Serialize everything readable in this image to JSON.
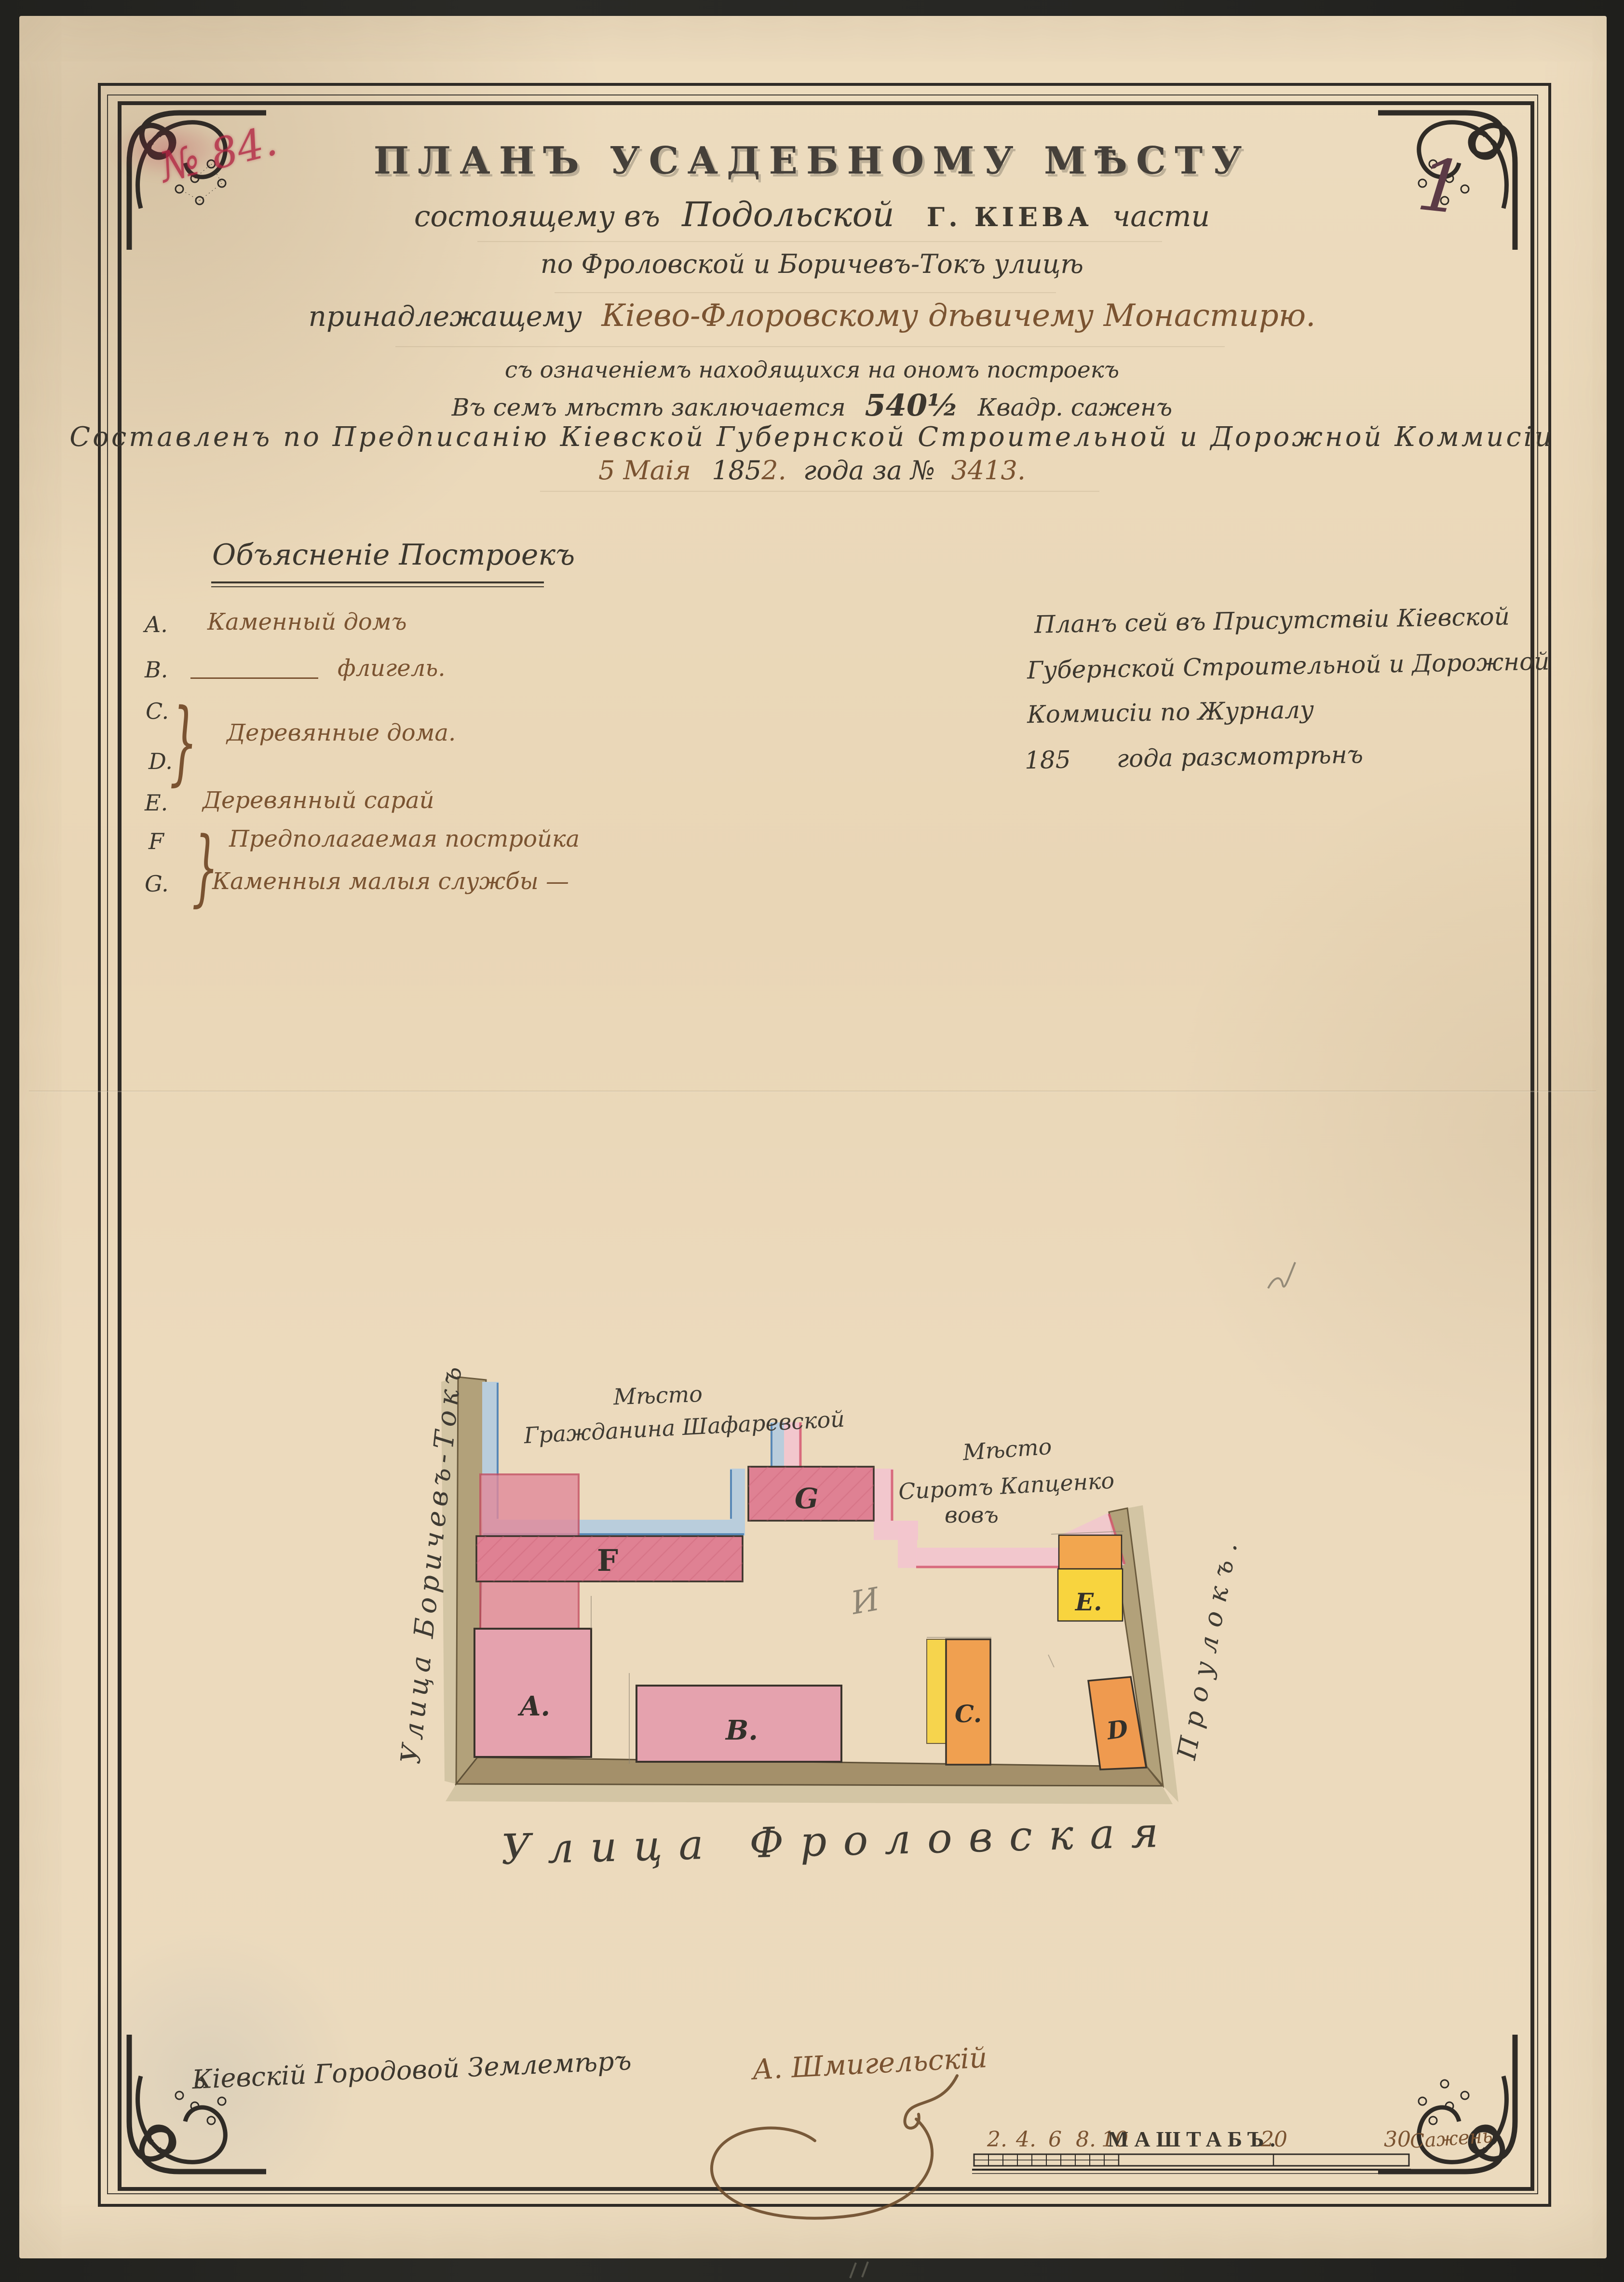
{
  "colors": {
    "paper": "#ecdcbf",
    "background": "#23231f",
    "ink": "#3c372e",
    "sepia": "#7a5331",
    "red_stamp": "#b22643",
    "pink_building": "#df8193",
    "pink_light": "#e5a2ae",
    "yellow": "#f6d44d",
    "orange": "#f0a050",
    "blue_band": "#b9cddc",
    "blue_edge": "#4e81b2",
    "pink_band": "#f2c6cd",
    "crimson_edge": "#d4596e",
    "street_tan": "#b2a17a"
  },
  "header": {
    "stamp": "№ 84.",
    "folio": "1"
  },
  "title_block": {
    "line1": "ПЛАНЪ УСАДЕБНОМУ МѢСТУ",
    "line2_pre": "состоящему въ",
    "line2_place": "Подольской",
    "line2_city": "Г. КІЕВА",
    "line2_post": "части",
    "line3": "по Фроловской и Боричевъ-Токъ улицѣ",
    "line4_pre": "принадлежащему",
    "line4_owner": "Кіево-Флоровскому дѣвичему Монастирю.",
    "line5": "съ означеніемъ находящихся на ономъ построекъ",
    "line6_pre": "Въ семъ мѣстѣ заключается",
    "line6_area": "540½",
    "line6_post": "Квадр. саженъ",
    "line7": "Составленъ по Предписанію Кіевской Губернской Строительной и Дорожной Коммисіи",
    "line8_d1": "5 Маія",
    "line8_d2": "185",
    "line8_d3": "2.",
    "line8_d4": "года за №",
    "line8_d5": "3413."
  },
  "legend": {
    "heading": "Объясненіе Построекъ",
    "cd_text": "Деревянные дома.",
    "brace": "}",
    "items": [
      {
        "letter": "A.",
        "text": "Каменный домъ"
      },
      {
        "letter": "B.",
        "text": "флигель."
      },
      {
        "letter": "C.",
        "text": ""
      },
      {
        "letter": "D.",
        "text": ""
      },
      {
        "letter": "E.",
        "text": "Деревянный сарай"
      },
      {
        "letter": "F",
        "text": "Предполагаемая постройка"
      },
      {
        "letter": "G.",
        "text": "Каменныя малыя службы —"
      }
    ]
  },
  "review_note": {
    "line1": "Планъ сей въ Присутствіи Кіевской",
    "line2": "Губернской Строительной и Дорожной",
    "line3": "Коммисіи по Журналу",
    "line4": "185      года разсмотрѣнъ"
  },
  "plan": {
    "streets": {
      "left": "Улица Боричевъ-Токъ",
      "bottom": "Улица Фроловская",
      "right": "Проулокъ."
    },
    "neighbors": {
      "top_line1": "Мѣсто",
      "top_line2": "Гражданина Шафаревской",
      "right_line1": "Мѣсто",
      "right_line2": "Сиротъ Капценко",
      "right_line3": "вовъ"
    },
    "buildings": [
      {
        "id": "A."
      },
      {
        "id": "B."
      },
      {
        "id": "C."
      },
      {
        "id": "D"
      },
      {
        "id": "E."
      },
      {
        "id": "F"
      },
      {
        "id": "G"
      }
    ],
    "pencil_mark": "И"
  },
  "signature": {
    "title": "Кіевскій Городовой Землемѣръ",
    "name": "А. Шмигельскій"
  },
  "scale_bar": {
    "label": "МАШТАБЪ.",
    "n2": "2.",
    "n4": "4.",
    "n6": "6",
    "n8": "8.",
    "n10": "10",
    "n20": "20",
    "n30": "30",
    "unit": "Сажень"
  }
}
